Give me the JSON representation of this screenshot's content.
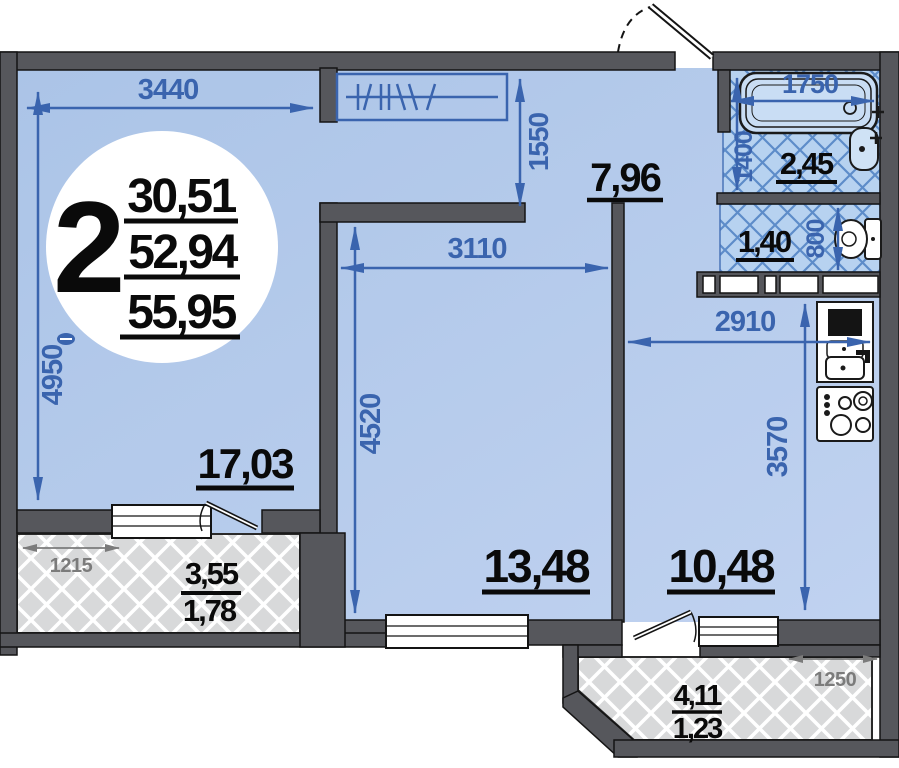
{
  "badge": {
    "room_count": "2",
    "living_area": "30,51",
    "apartment_area": "52,94",
    "total_area": "55,95"
  },
  "rooms": {
    "living_room": {
      "area_label": "17,03",
      "width_mm": "3440",
      "height_mm": "4950"
    },
    "bedroom": {
      "area_label": "13,48",
      "width_mm": "3110",
      "height_mm": "4520"
    },
    "kitchen": {
      "area_label": "10,48",
      "width_mm": "2910",
      "height_mm": "3570"
    },
    "hallway": {
      "area_label": "7,96",
      "closet_depth_mm": "1550"
    },
    "bathroom": {
      "area_label": "2,45",
      "tub_length_mm": "1750",
      "width_mm": "1400"
    },
    "toilet": {
      "area_label": "1,40",
      "width_mm": "800"
    },
    "balcony_left": {
      "area_total": "3,55",
      "area_counted": "1,78",
      "width_mm": "1215"
    },
    "balcony_right": {
      "area_total": "4,11",
      "area_counted": "1,23",
      "width_mm": "1250"
    }
  },
  "fixtures": [
    "bathtub",
    "washbasin",
    "toilet-bowl",
    "kitchen-sink",
    "stove",
    "wardrobe-rail",
    "entrance-door",
    "balcony-doors",
    "windows"
  ],
  "colors": {
    "wall": "#56575c",
    "room_fill": "#b4c9ea",
    "dimension_blue": "#3a64ae",
    "tile_fill": "#b7d2f0",
    "tile_line": "#5d8cc9",
    "balcony_fill": "#d8d9da",
    "gray_dimension": "#7b7b7b",
    "label_black": "#0a0a0a"
  }
}
